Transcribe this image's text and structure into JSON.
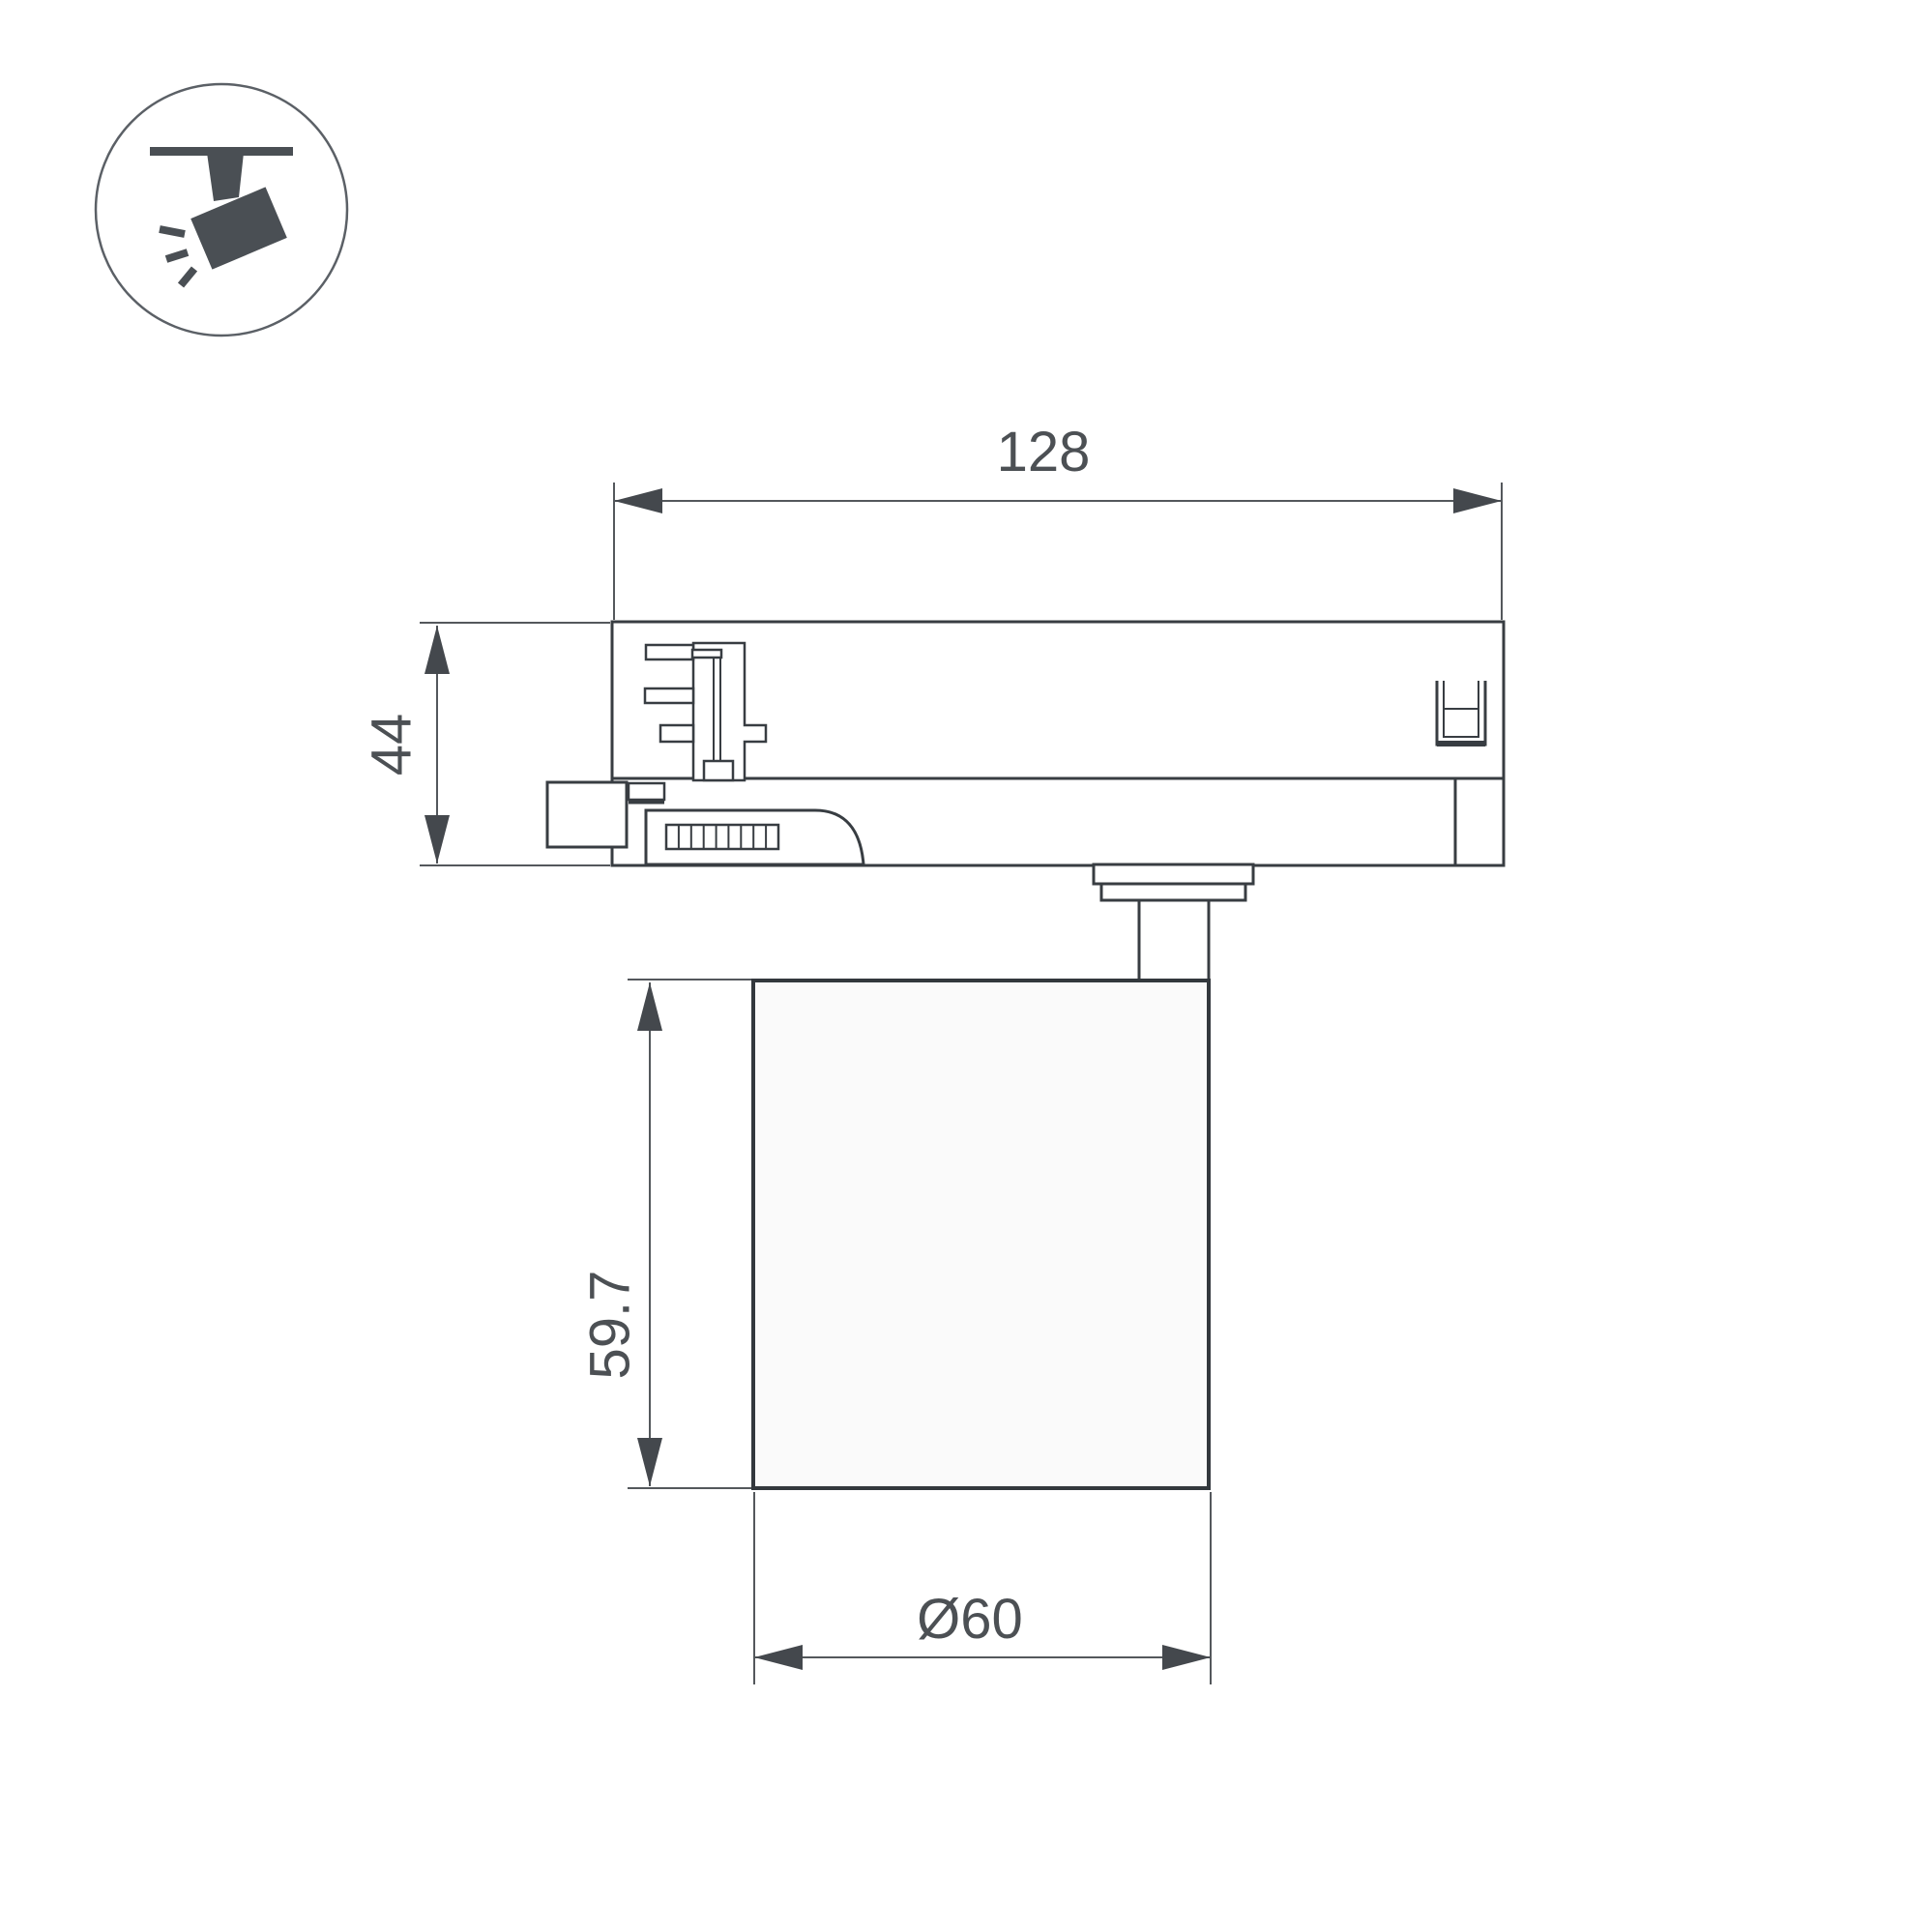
{
  "drawing": {
    "type": "technical-dimension-drawing",
    "subject": "track-mounted spotlight, side view",
    "background": "#ffffff"
  },
  "colors": {
    "object_line": "#383d42",
    "dimension_line": "#54585c",
    "text": "#4c5054",
    "icon": "#4a4f54",
    "lamp_fill": "#fafafa"
  },
  "legend_icon": {
    "name": "ceiling-track-spotlight"
  },
  "dimensions": {
    "adapter_width": "128",
    "adapter_height": "44",
    "body_height": "59.7",
    "body_diameter": "Ø60"
  }
}
